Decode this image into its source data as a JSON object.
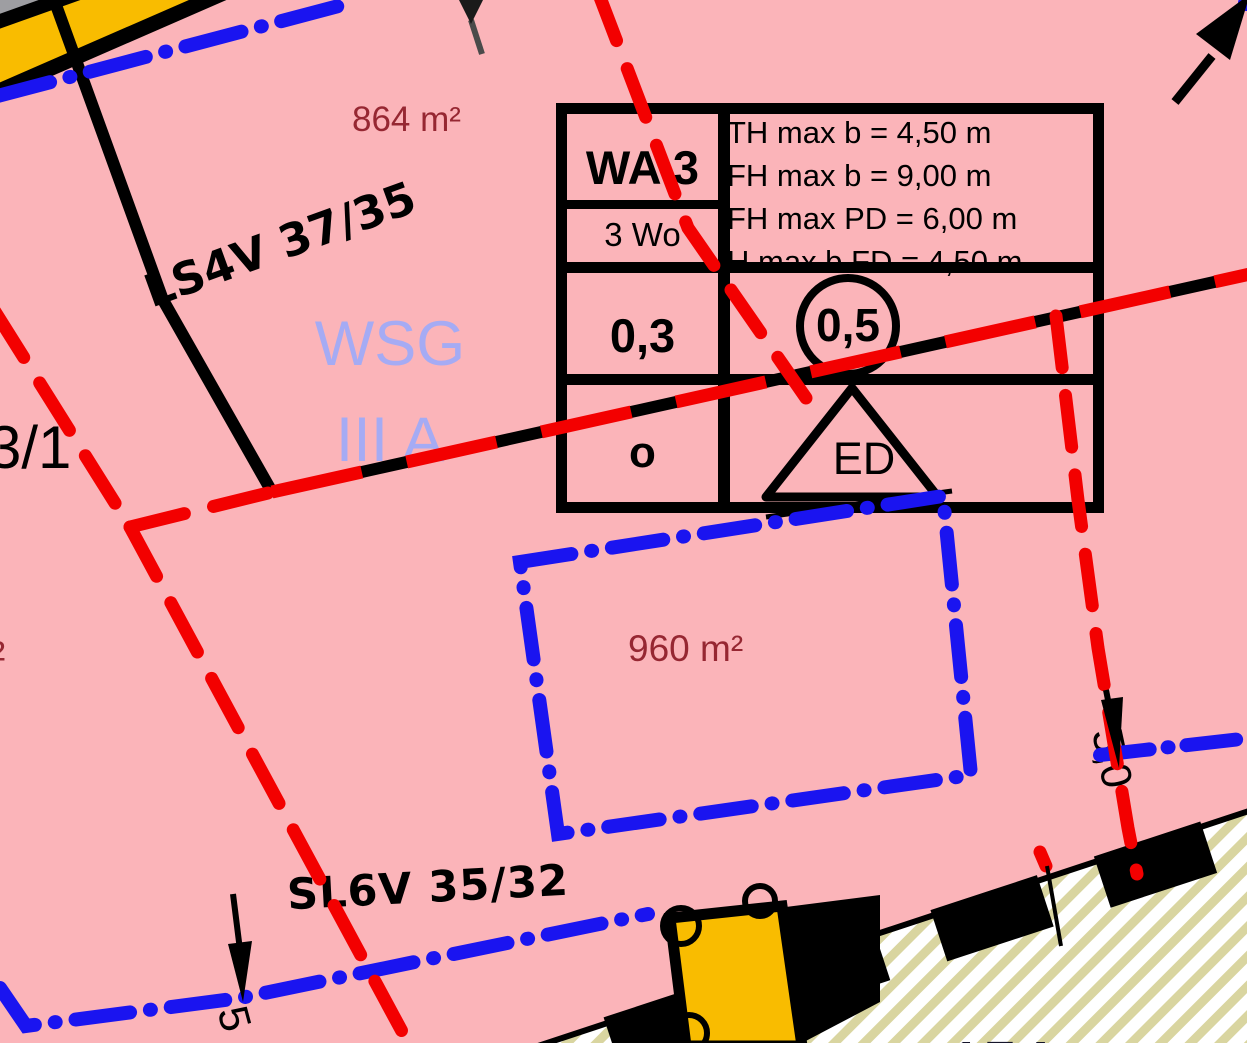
{
  "colors": {
    "background_pink": "#FBB4B9",
    "boundary_red": "#F30000",
    "utility_blue": "#1A14F0",
    "area_text_red": "#962732",
    "water_zone_blue": "#A5ABF4",
    "building_yellow": "#F9BC00",
    "hatch_khaki": "#D9D5A0"
  },
  "plan_table": {
    "zone": "WA 3",
    "dwellings": "3 Wo",
    "grz": "0,3",
    "building_type": "o",
    "gfz": "0,5",
    "roof_form": "ED",
    "height_rules": [
      "TH max b = 4,50 m",
      "FH max b = 9,00 m",
      "FH max PD = 6,00 m",
      "H max b FD = 4,50 m"
    ]
  },
  "labels": {
    "area_parcel_top": "864 m²",
    "area_parcel_middle": "960 m²",
    "area_fragment_left": "²",
    "parcel_number_left": "3/1",
    "parcel_number_bottom": "174",
    "pipeline_label_top": "LS4V 37/35",
    "pipeline_label_bottom": "SL6V 35/32",
    "water_protection_line1": "WSG",
    "water_protection_line2": "III A",
    "dimension_right": "5,0",
    "dimension_bottom_left": "5"
  }
}
